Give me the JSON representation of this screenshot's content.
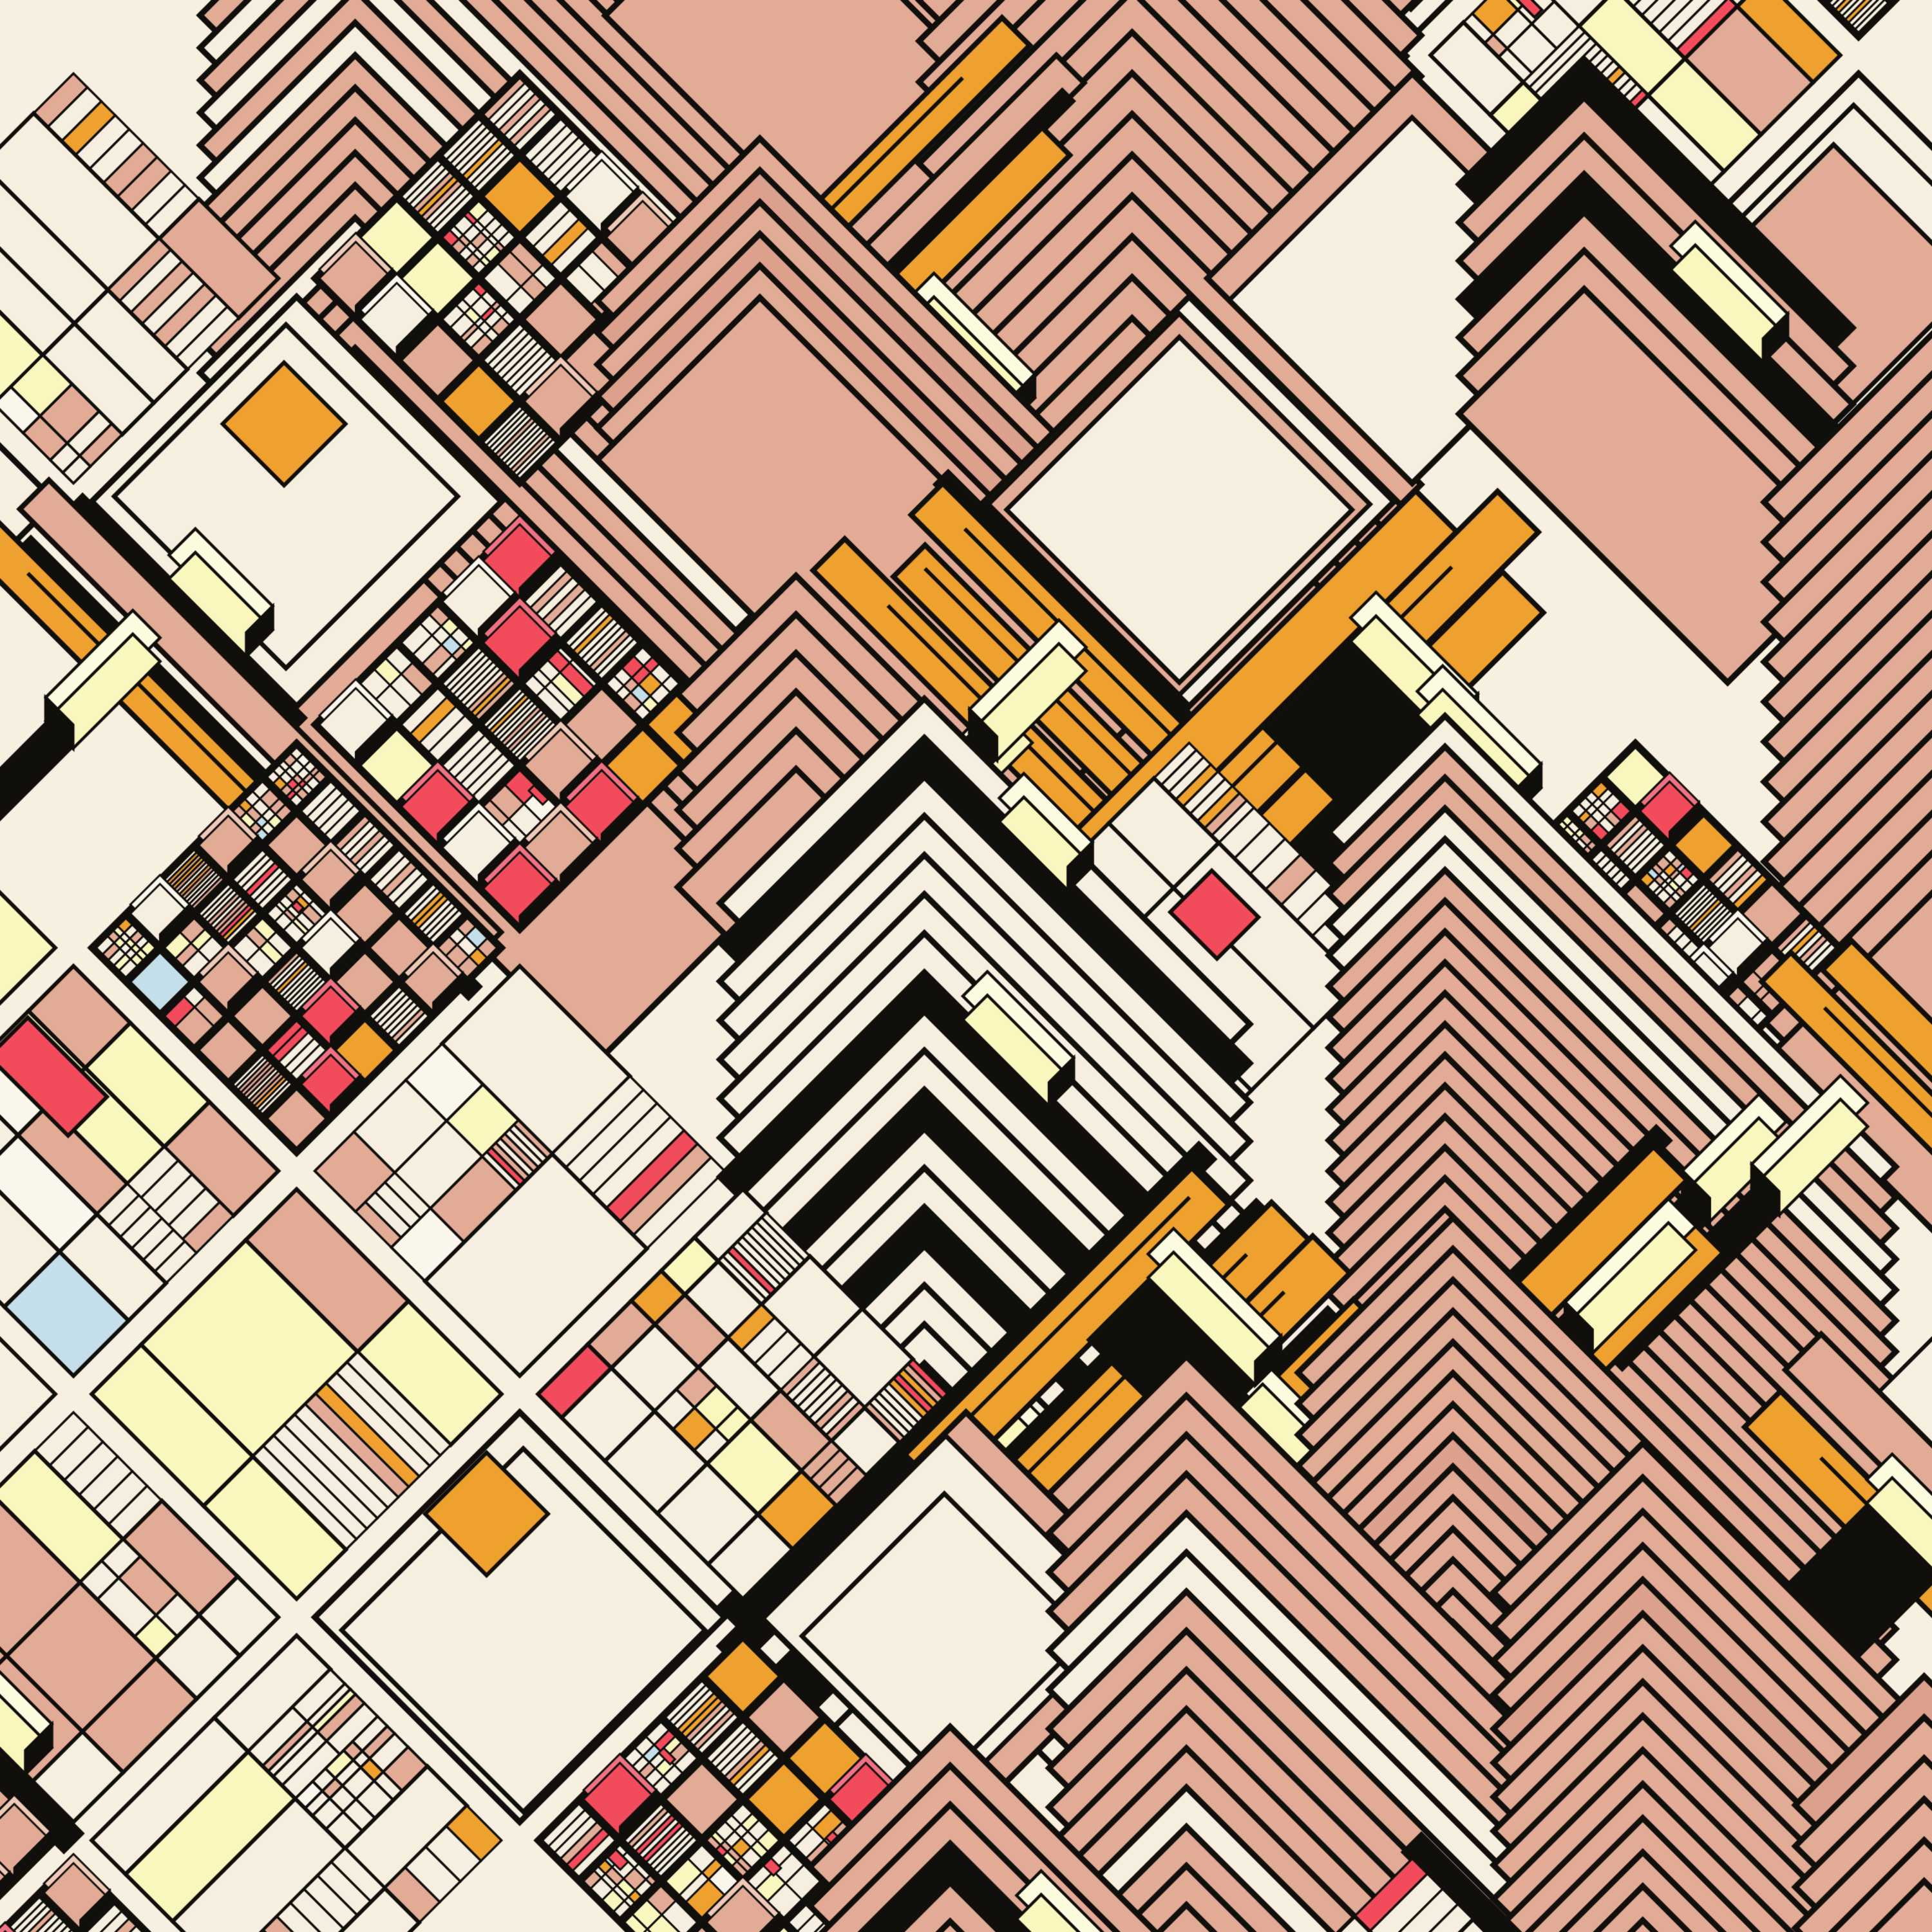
{
  "artwork": {
    "kind": "generative-geometric-cityscape",
    "palette": {
      "background": "#F7F0E1",
      "cream": "#F6EFE0",
      "creamBright": "#FBF6EC",
      "salmon": "#E2AB96",
      "salmonDeep": "#DBA18C",
      "salmonLight": "#EFC9B8",
      "paleYellow": "#F9F6BE",
      "paleYellowTop": "#FCFADF",
      "orange": "#EEA12E",
      "red": "#F24B5C",
      "redLight": "#EF7184",
      "skyBlue": "#C5DFEA",
      "black": "#110F0C"
    },
    "layout": {
      "canvasSize": 3000,
      "rotationDeg": 45,
      "blockSize": 450,
      "streetWidth": 40,
      "gridMin": -5,
      "gridMax": 4,
      "seed": 1376203,
      "chevronStep": 34,
      "strokeMain": 9,
      "strokeGrid": 6,
      "strokeFine": 3.5,
      "boxDepth": 26
    },
    "blockWeights": {
      "chevron": 0.3,
      "mondrian": 0.28,
      "dense": 0.16,
      "bars": 0.12,
      "bigtile": 0.08,
      "empty": 0.06
    },
    "cellWeights": {
      "cream": 0.5,
      "salmon": 0.235,
      "paleYellow": 0.11,
      "orange": 0.08,
      "red": 0.04,
      "skyBlue": 0.015,
      "creamBright": 0.02
    },
    "features": {
      "wideStreetChance": 0.12,
      "blackBandChance": 0.09,
      "boxOnBandChance": 0.6
    }
  }
}
